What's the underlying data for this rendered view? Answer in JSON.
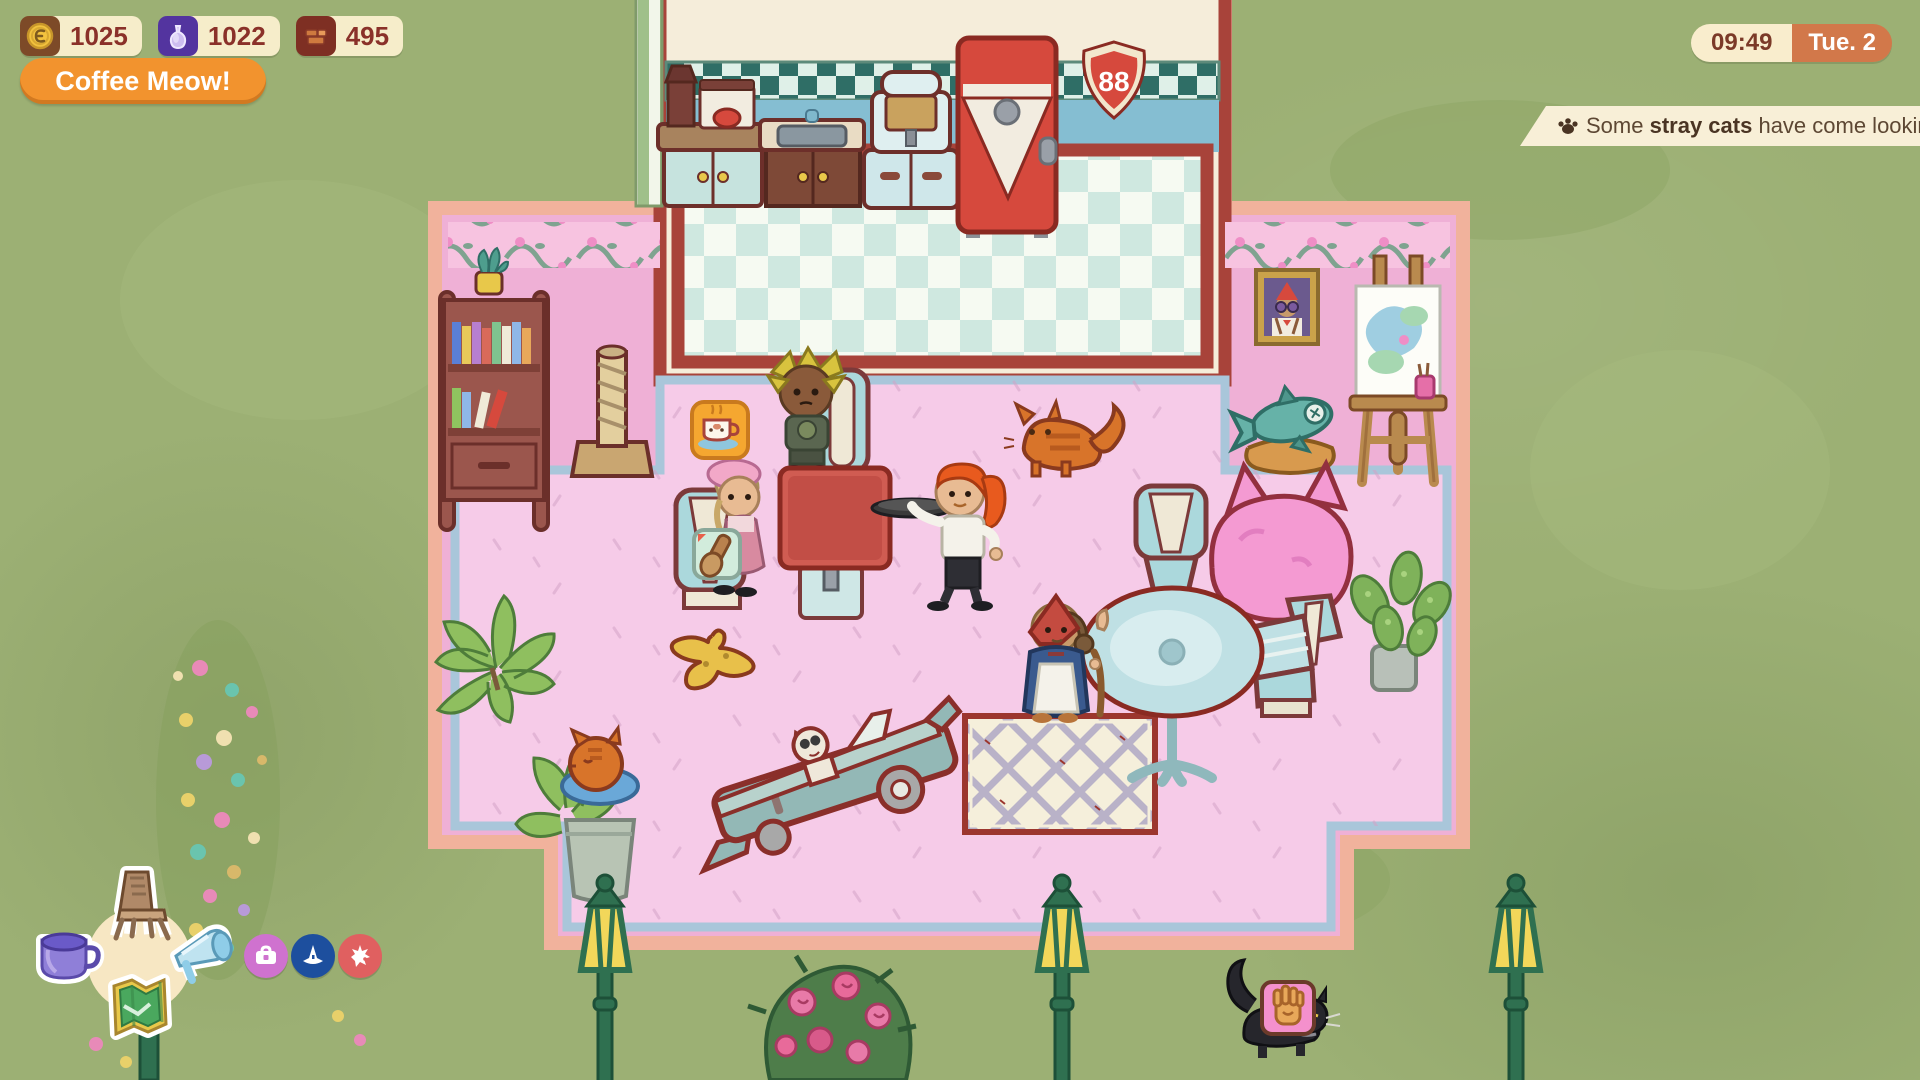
{
  "hud": {
    "currencies": [
      {
        "id": "coins",
        "icon": "coin-icon",
        "value": "1025"
      },
      {
        "id": "essence",
        "icon": "flask-icon",
        "value": "1022"
      },
      {
        "id": "bricks",
        "icon": "bricks-icon",
        "value": "495"
      }
    ],
    "action_button": {
      "label": "Coffee Meow!"
    },
    "clock": {
      "time": "09:49",
      "day": "Tue. 2"
    },
    "notification": {
      "icon": "paw-icon",
      "prefix": "Some ",
      "bold": "stray cats",
      "suffix": " have come looking"
    },
    "radial_menu": {
      "center_items": [
        {
          "id": "furniture",
          "icon": "chair-icon"
        },
        {
          "id": "drinks",
          "icon": "coffee-cup-icon"
        },
        {
          "id": "marketing",
          "icon": "megaphone-icon"
        },
        {
          "id": "map",
          "icon": "map-icon"
        }
      ],
      "quick_buttons": [
        {
          "id": "supplies",
          "icon": "briefcase-icon",
          "color": "#cf72cf"
        },
        {
          "id": "wizard",
          "icon": "wizard-hat-icon",
          "color": "#1d4f9e"
        },
        {
          "id": "punk",
          "icon": "burst-icon",
          "color": "#e06060"
        }
      ]
    },
    "colors": {
      "hud_cream": "#f6edca",
      "text_brown": "#8a3129",
      "button_orange": "#f2932e",
      "clock_day_bg": "#d2784a",
      "notification_bg": "#f8efd7",
      "background_green": "#9cb074",
      "floor_pink": "#f6cbe8",
      "wall_pink": "#efb0d6",
      "fridge_red": "#d6493d"
    }
  },
  "scene": {
    "route_sign_text": "88",
    "entities": [
      {
        "name": "coffee-grinder-station",
        "label": "Coffee grinder and brewer on counter"
      },
      {
        "name": "kitchen-sink-counter",
        "label": "Sink counter"
      },
      {
        "name": "espresso-machine",
        "label": "Espresso machine cabinet"
      },
      {
        "name": "retro-fridge",
        "label": "Red retro refrigerator"
      },
      {
        "name": "route-sign",
        "label": "Route 88 shield sign"
      },
      {
        "name": "bookshelf",
        "label": "Bookshelf with plant"
      },
      {
        "name": "scratching-post",
        "label": "Cat scratching post"
      },
      {
        "name": "order-bubble",
        "label": "Order bubble with coffee cup"
      },
      {
        "name": "request-bubble",
        "label": "Request bubble with wooden item"
      },
      {
        "name": "customer-punk",
        "label": "Customer with blond spiky pigtails and skull shirt"
      },
      {
        "name": "customer-beret",
        "label": "Customer with pink beret and dress"
      },
      {
        "name": "waitress",
        "label": "Waitress with orange ponytail carrying tray"
      },
      {
        "name": "staff-housekeeper",
        "label": "Staff with red headscarf, apron and broom"
      },
      {
        "name": "cat-ginger",
        "label": "Ginger cat walking"
      },
      {
        "name": "cat-black",
        "label": "Black stray cat outside"
      },
      {
        "name": "petting-bubble",
        "label": "Pink bubble with hand icon"
      },
      {
        "name": "diner-table",
        "label": "Red diner table"
      },
      {
        "name": "round-table",
        "label": "Teal pedestal table"
      },
      {
        "name": "diner-chairs",
        "label": "Teal diner chairs"
      },
      {
        "name": "cat-topiary",
        "label": "Pink fluffy cat-shaped topiary"
      },
      {
        "name": "fish-toy-bed",
        "label": "Fish toy on cat bed"
      },
      {
        "name": "cat-portrait",
        "label": "Framed portrait of cat with sunglasses"
      },
      {
        "name": "painting-easel",
        "label": "Easel with abstract painting"
      },
      {
        "name": "banana-peel",
        "label": "Banana peel on floor"
      },
      {
        "name": "car-cat-bed",
        "label": "Vintage car cutout with cat driver"
      },
      {
        "name": "lattice-rug",
        "label": "Cream lattice rug"
      },
      {
        "name": "planter-sleeping-cat",
        "label": "Planter with sleeping orange cat"
      },
      {
        "name": "monstera-plant",
        "label": "Potted monstera plant"
      },
      {
        "name": "leafy-plant",
        "label": "Leafy green plant"
      },
      {
        "name": "rose-bush",
        "label": "Rose bush outside"
      },
      {
        "name": "lamp-post",
        "label": "Green street lamp"
      },
      {
        "name": "flower-bed",
        "label": "Watercolor flower bed"
      }
    ]
  }
}
